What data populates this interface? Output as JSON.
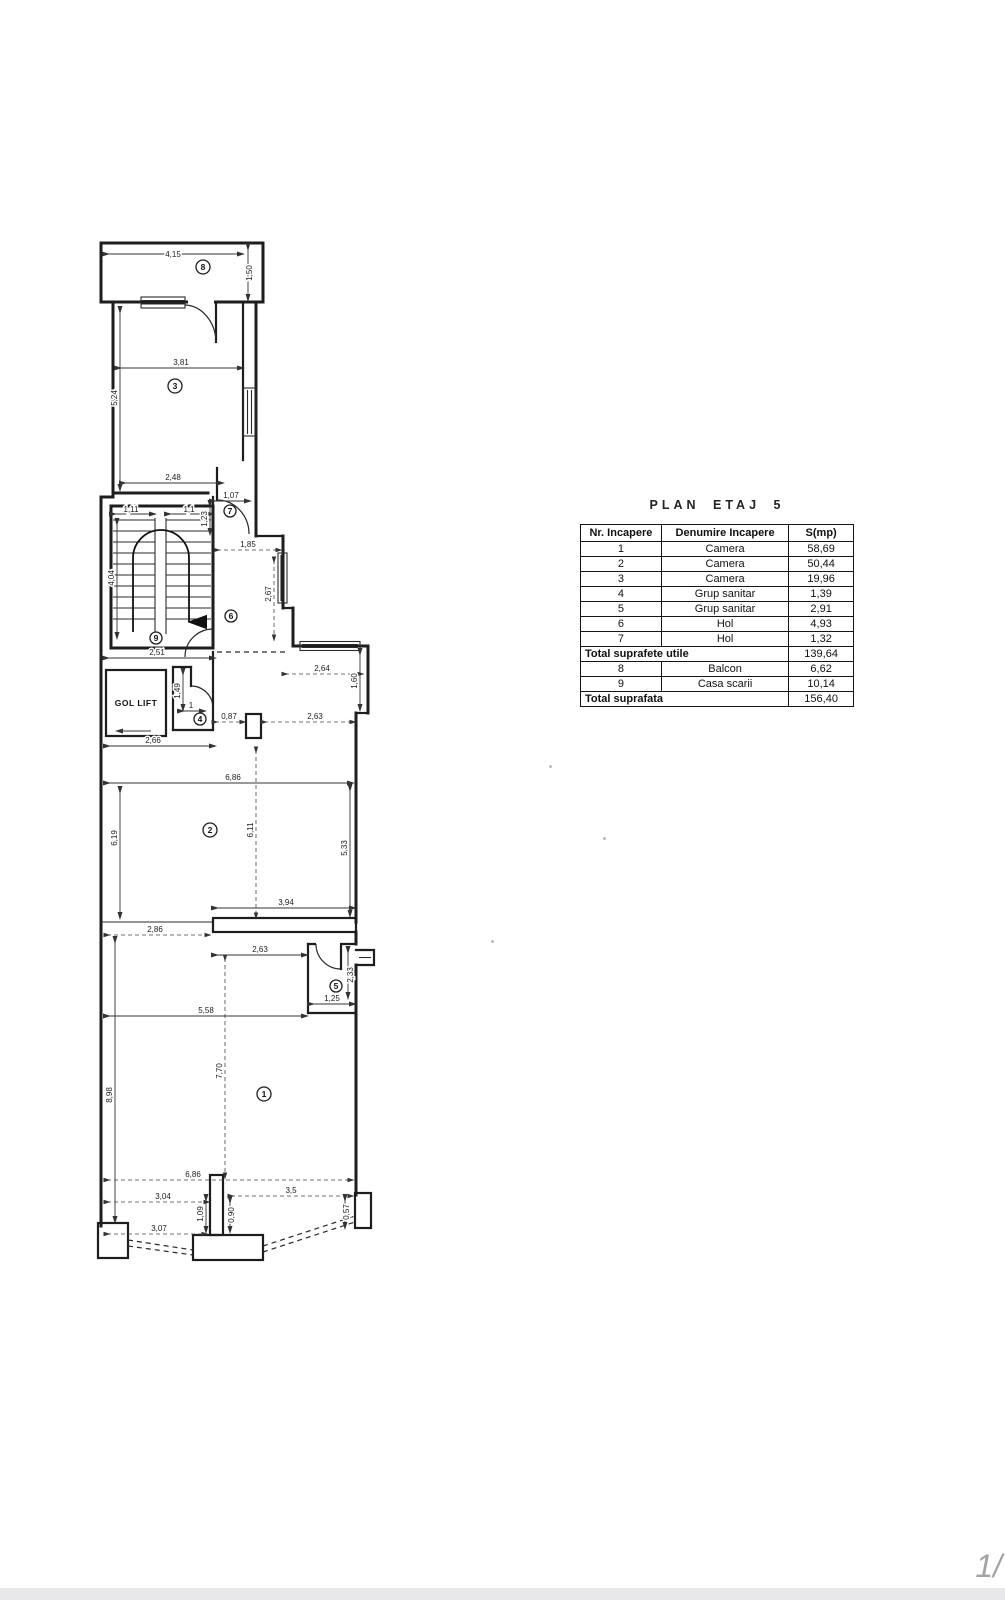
{
  "table": {
    "title": "PLAN ETAJ 5",
    "headers": [
      "Nr. Incapere",
      "Denumire Incapere",
      "S(mp)"
    ],
    "rows": [
      {
        "nr": "1",
        "name": "Camera",
        "s": "58,69"
      },
      {
        "nr": "2",
        "name": "Camera",
        "s": "50,44"
      },
      {
        "nr": "3",
        "name": "Camera",
        "s": "19,96"
      },
      {
        "nr": "4",
        "name": "Grup sanitar",
        "s": "1,39"
      },
      {
        "nr": "5",
        "name": "Grup sanitar",
        "s": "2,91"
      },
      {
        "nr": "6",
        "name": "Hol",
        "s": "4,93"
      },
      {
        "nr": "7",
        "name": "Hol",
        "s": "1,32"
      }
    ],
    "total_utile": {
      "label": "Total suprafete utile",
      "s": "139,64"
    },
    "extra_rows": [
      {
        "nr": "8",
        "name": "Balcon",
        "s": "6,62"
      },
      {
        "nr": "9",
        "name": "Casa scarii",
        "s": "10,14"
      }
    ],
    "total": {
      "label": "Total suprafata",
      "s": "156,40"
    }
  },
  "plan": {
    "gol_lift_label": "GOL LIFT",
    "rooms": {
      "r1": "1",
      "r2": "2",
      "r3": "3",
      "r4": "4",
      "r5": "5",
      "r6": "6",
      "r7": "7",
      "r8": "8",
      "r9": "9"
    },
    "dims": {
      "balcony_w": "4,15",
      "balcony_d": "1,50",
      "room3_w": "3,81",
      "room3_h": "5,24",
      "room3_wb": "2,48",
      "hall7_w": "1,07",
      "hall7_h": "1,23",
      "stair_w1": "1,11",
      "stair_w2": "1,1",
      "stair_h": "4,04",
      "stair_wb": "2,51",
      "hol6_w": "1,85",
      "hol6_h": "2,67",
      "notch_w": "2,64",
      "notch_h": "1,60",
      "ws4_h": "1,49",
      "ws4_w1": "1",
      "ws4_w": "0,87",
      "corridor_w": "2,63",
      "lift_wb": "2,66",
      "room2_w": "6,86",
      "room2_hl": "6,19",
      "room2_hm": "6,11",
      "room2_hr": "5,33",
      "room2_wb": "3,94",
      "room2_wbl": "2,86",
      "room1_wt": "2,63",
      "ws5_w": "1,25",
      "ws5_h": "2,33",
      "room1_w1": "5,58",
      "room1_hm": "7,70",
      "room1_hl": "8,98",
      "room1_wb": "6,86",
      "bot_1": "3,04",
      "bot_2": "3,5",
      "bot_3": "3,07",
      "bot_4": "1,09",
      "bot_5": "0,90",
      "bot_6": "0,57"
    }
  },
  "footer": {
    "page": "1/"
  }
}
